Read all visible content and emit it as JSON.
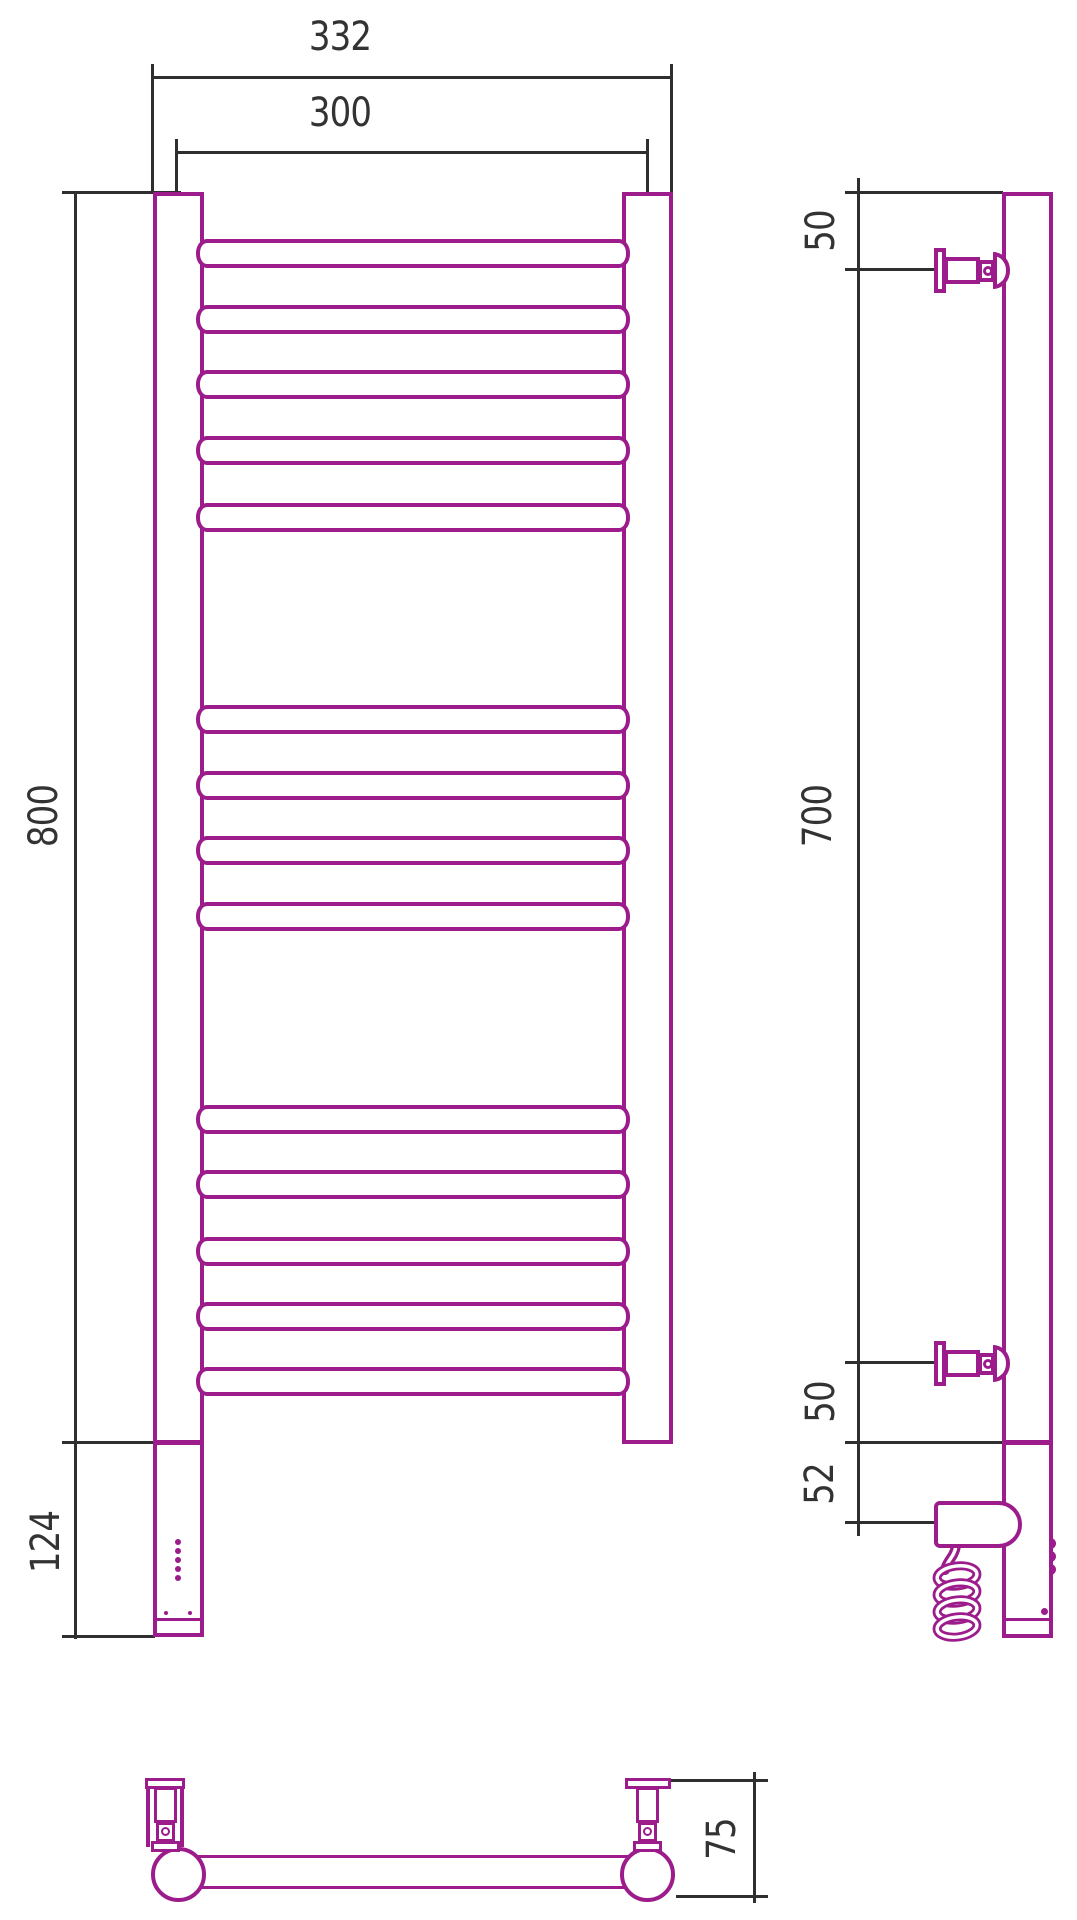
{
  "drawing": {
    "title": "towel-rail-dimension-drawing",
    "colors": {
      "outline": "#9C1C8C",
      "dimension": "#2F2F2F"
    },
    "dimensions": {
      "top_outer_width": "332",
      "top_center_width": "300",
      "left_height": "800",
      "left_heater_height": "124",
      "side_top_offset": "50",
      "side_bracket_span": "700",
      "side_bottom_offset": "50",
      "side_heater_offset": "52",
      "bottom_depth": "75"
    }
  }
}
